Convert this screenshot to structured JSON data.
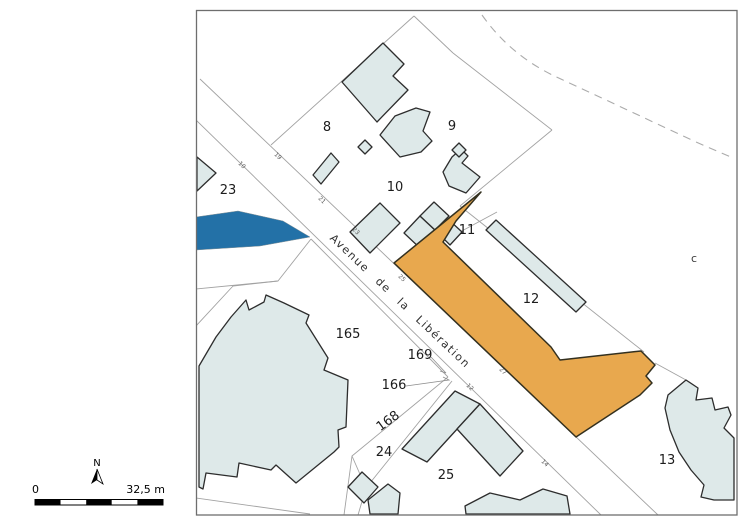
{
  "map": {
    "street_name": "Avenue de la Libération",
    "section_label": "c",
    "parcel_labels": {
      "p8": "8",
      "p9": "9",
      "p10": "10",
      "p11": "11",
      "p12": "12",
      "p13": "13",
      "p23": "23",
      "p24": "24",
      "p25": "25",
      "p165": "165",
      "p166": "166",
      "p168": "168",
      "p169": "169"
    },
    "address_numbers": {
      "a10": "10",
      "a19": "19",
      "a21": "21",
      "a23": "23",
      "a25": "25",
      "a27": "27",
      "a12": "12",
      "a14": "14"
    }
  },
  "legend": {
    "north_label": "N",
    "scale_zero": "0",
    "scale_max": "32,5 m"
  },
  "colors": {
    "highlighted_building": "#E8A84E",
    "water": "#2371A7",
    "building_fill": "#DEE9E9",
    "parcel_line": "#A2A2A2"
  }
}
